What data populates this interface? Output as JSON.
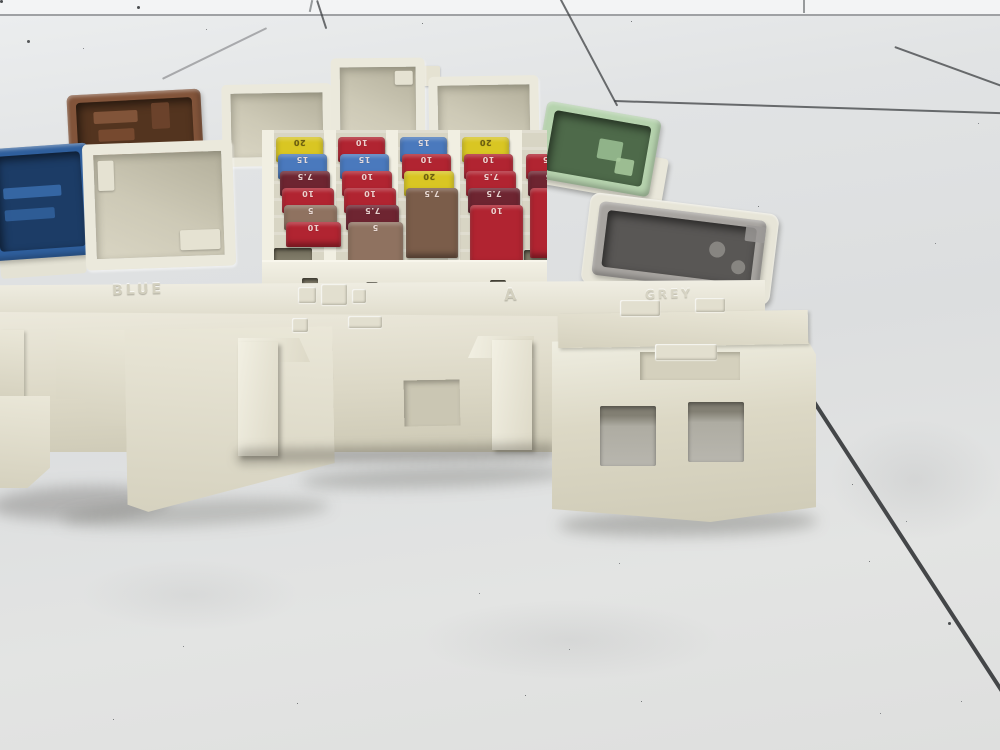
{
  "scene": {
    "subject": "Automotive fuse/junction box photographed at floor level on white glossy tiles",
    "floor": {
      "tile_color": "#e2e4e5",
      "wall_color": "#f3f4f5",
      "grout_color": "#3e4043"
    },
    "box_body_color": "#e9e7da"
  },
  "fusebox": {
    "embossed_labels": {
      "blue": "BLUE",
      "grey": "GREY",
      "a_mark": "A"
    },
    "connectors": {
      "brown": {
        "rim": "#82543a",
        "inner": "#53341f"
      },
      "blue": {
        "rim": "#2f5f9d",
        "inner": "#1c3c66"
      },
      "green": {
        "rim": "#b6d3ae",
        "inner": "#4e6a4a"
      },
      "grey": {
        "rim": "#a7a4a0",
        "inner": "#595755"
      }
    }
  },
  "fuses": {
    "color_legend": {
      "20": "yellow",
      "15": "blue",
      "10": "red",
      "7.5": "brown/maroon",
      "5": "tan"
    },
    "palette": {
      "yellow": "#d9c623",
      "blue": "#4a79bd",
      "red": "#b12431",
      "maroon": "#6e2531",
      "brown": "#7b5d4a",
      "tan": "#8f7260"
    },
    "label_colors": {
      "yellow": "#6b5e10",
      "default": "rgba(255,240,235,0.85)"
    },
    "items": [
      {
        "col": 0,
        "row": 0,
        "color": "yellow",
        "amps": "20"
      },
      {
        "col": 0,
        "row": 1,
        "color": "blue",
        "amps": "15"
      },
      {
        "col": 0,
        "row": 2,
        "color": "maroon",
        "amps": "7.5"
      },
      {
        "col": 0,
        "row": 3,
        "color": "red",
        "amps": "10"
      },
      {
        "col": 0,
        "row": 4,
        "color": "tan",
        "amps": "5"
      },
      {
        "col": 0,
        "row": 5,
        "color": "red",
        "amps": "10"
      },
      {
        "col": 1,
        "row": 0,
        "color": "red",
        "amps": "10"
      },
      {
        "col": 1,
        "row": 1,
        "color": "blue",
        "amps": "15"
      },
      {
        "col": 1,
        "row": 2,
        "color": "red",
        "amps": "10"
      },
      {
        "col": 1,
        "row": 3,
        "color": "red",
        "amps": "10"
      },
      {
        "col": 1,
        "row": 4,
        "color": "maroon",
        "amps": "7.5"
      },
      {
        "col": 1,
        "row": 5,
        "color": "tan",
        "amps": "5",
        "tall": true
      },
      {
        "col": 2,
        "row": 0,
        "color": "blue",
        "amps": "15"
      },
      {
        "col": 2,
        "row": 1,
        "color": "red",
        "amps": "10"
      },
      {
        "col": 2,
        "row": 2,
        "color": "yellow",
        "amps": "20"
      },
      {
        "col": 2,
        "row": 3,
        "color": "brown",
        "amps": "7.5",
        "tall": true
      },
      {
        "col": 3,
        "row": 0,
        "color": "yellow",
        "amps": "20"
      },
      {
        "col": 3,
        "row": 1,
        "color": "red",
        "amps": "10"
      },
      {
        "col": 3,
        "row": 2,
        "color": "red",
        "amps": "7.5"
      },
      {
        "col": 3,
        "row": 3,
        "color": "maroon",
        "amps": "7.5"
      },
      {
        "col": 3,
        "row": 4,
        "color": "red",
        "amps": "10",
        "tall": true
      },
      {
        "col": 4,
        "row": 1,
        "color": "red",
        "amps": "7.5"
      },
      {
        "col": 4,
        "row": 2,
        "color": "maroon",
        "amps": "7.5"
      },
      {
        "col": 4,
        "row": 3,
        "color": "red",
        "amps": "10",
        "tall": true
      }
    ]
  }
}
